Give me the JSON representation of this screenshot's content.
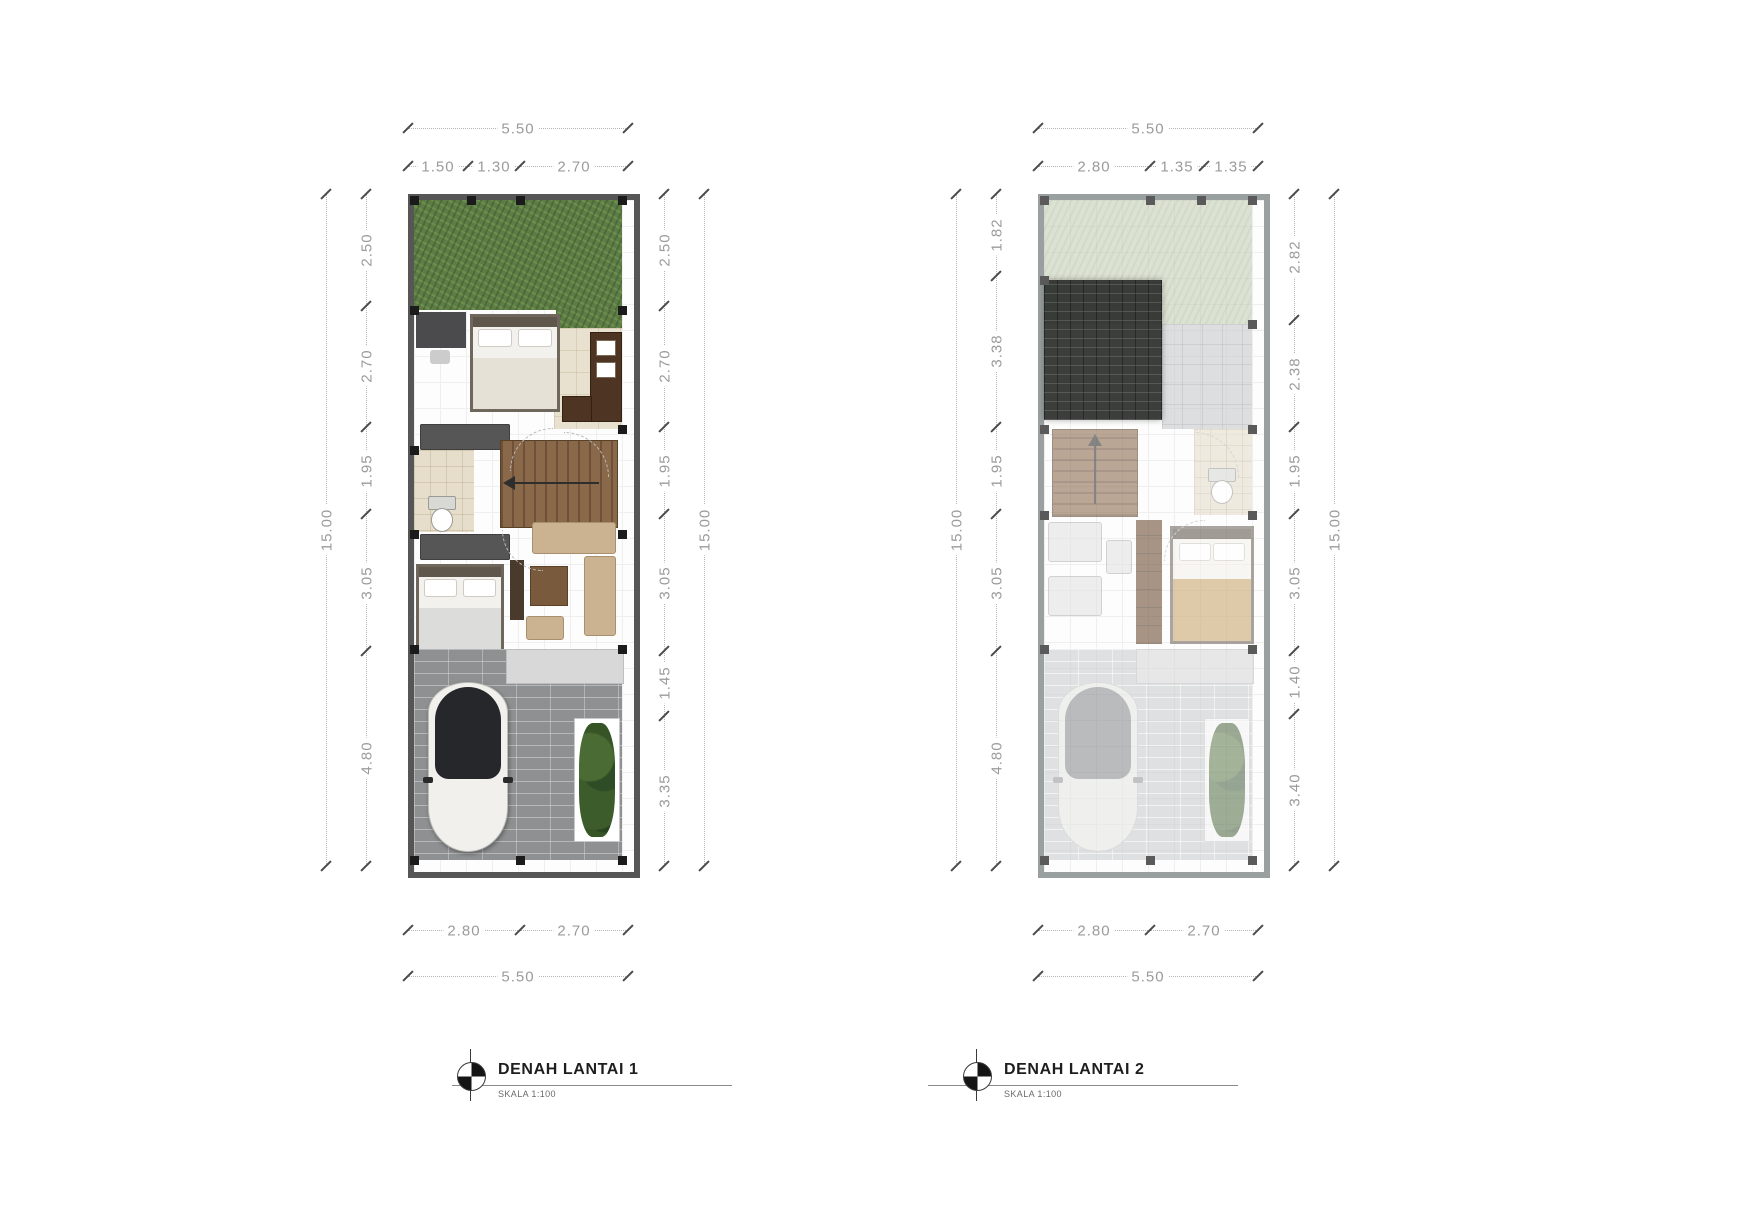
{
  "page": {
    "background": "#ffffff"
  },
  "colors": {
    "page_bg": "#ffffff",
    "wall": "#565656",
    "wall_faded": "#9aa0a0",
    "dim_text": "#9b9b9b",
    "dim_line": "#b5b5b5",
    "tick": "#4a4a4a",
    "grass": "#5e7d46",
    "grass_faded": "#c5cfb5",
    "paving": "#8e9092",
    "paving_faded": "#caccce",
    "roof": "#2b2e2b",
    "tile": "#e9e1cf",
    "title_text": "#1e1e1e",
    "subtitle_text": "#6a6a6a"
  },
  "plans": [
    {
      "title": "DENAH LANTAI 1",
      "scale_label": "SKALA 1:100",
      "dims": {
        "top_outer": [
          "5.50"
        ],
        "top_inner": [
          "1.50",
          "1.30",
          "2.70"
        ],
        "left_outer": [
          "15.00"
        ],
        "left_inner": [
          "2.50",
          "2.70",
          "1.95",
          "3.05",
          "4.80"
        ],
        "right_inner": [
          "2.50",
          "2.70",
          "1.95",
          "3.05",
          "1.45",
          "3.35"
        ],
        "right_outer": [
          "15.00"
        ],
        "bottom_inner": [
          "2.80",
          "2.70"
        ],
        "bottom_outer": [
          "5.50"
        ]
      }
    },
    {
      "title": "DENAH LANTAI 2",
      "scale_label": "SKALA 1:100",
      "dims": {
        "top_outer": [
          "5.50"
        ],
        "top_inner": [
          "2.80",
          "1.35",
          "1.35"
        ],
        "left_outer": [
          "15.00"
        ],
        "left_inner": [
          "1.82",
          "3.38",
          "1.95",
          "3.05",
          "4.80"
        ],
        "right_inner": [
          "2.82",
          "2.38",
          "1.95",
          "3.05",
          "1.40",
          "3.40"
        ],
        "right_outer": [
          "15.00"
        ],
        "bottom_inner": [
          "2.80",
          "2.70"
        ],
        "bottom_outer": [
          "5.50"
        ]
      }
    }
  ]
}
